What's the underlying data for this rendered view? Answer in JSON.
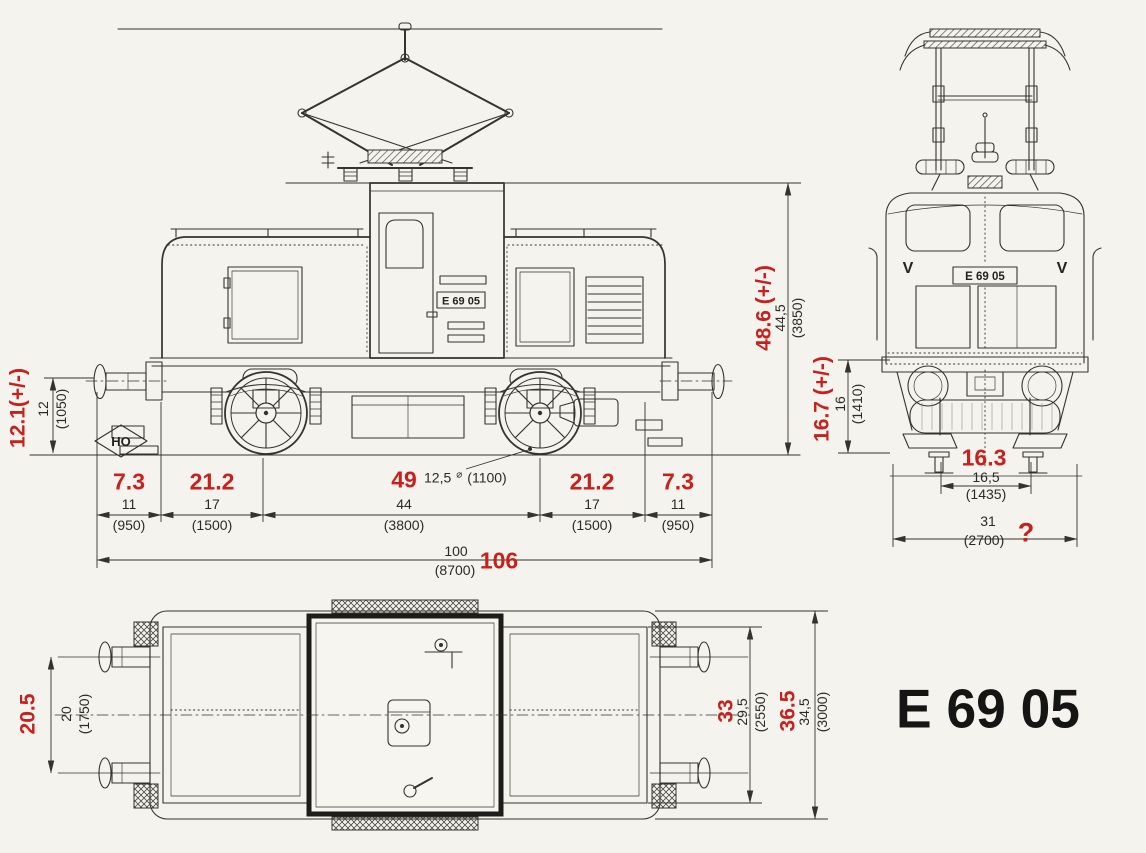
{
  "drawing_title": "E 69 05",
  "scale_logo": "HO",
  "side_view": {
    "number_plate": "E 69 05",
    "buffer_height": {
      "annotation": "12.1(+/-)",
      "model": "12",
      "prototype": "(1050)"
    },
    "overall_height": {
      "annotation": "48.6 (+/-)",
      "model": "44,5",
      "prototype": "(3850)"
    },
    "wheel_diameter": {
      "model": "12,5",
      "symbol": "⌀",
      "prototype": "(1100)"
    },
    "length_segments": [
      {
        "annotation": "7.3",
        "model": "11",
        "prototype": "(950)"
      },
      {
        "annotation": "21.2",
        "model": "17",
        "prototype": "(1500)"
      },
      {
        "annotation": "49",
        "model": "44",
        "prototype": "(3800)"
      },
      {
        "annotation": "21.2",
        "model": "17",
        "prototype": "(1500)"
      },
      {
        "annotation": "7.3",
        "model": "11",
        "prototype": "(950)"
      }
    ],
    "overall_length": {
      "model": "100",
      "prototype": "(8700)",
      "annotation": "106"
    }
  },
  "front_view": {
    "number_plate": "E 69 05",
    "marking_left": "V",
    "marking_right": "V",
    "buffer_height": {
      "annotation": "16.7 (+/-)",
      "model": "16",
      "prototype": "(1410)"
    },
    "track_gauge": {
      "annotation": "16.3",
      "model": "16,5",
      "prototype": "(1435)"
    },
    "overall_width": {
      "model": "31",
      "prototype": "(2700)",
      "annotation": "?"
    }
  },
  "plan_view": {
    "buffer_spacing": {
      "annotation": "20.5",
      "model": "20",
      "prototype": "(1750)"
    },
    "body_width": {
      "annotation": "33",
      "model": "29,5",
      "prototype": "(2550)"
    },
    "overall_width": {
      "annotation": "36.5",
      "model": "34,5",
      "prototype": "(3000)"
    }
  },
  "colors": {
    "annotation_red": "#c8201d",
    "ink": "#34332e",
    "paper": "#f5f3ee"
  }
}
